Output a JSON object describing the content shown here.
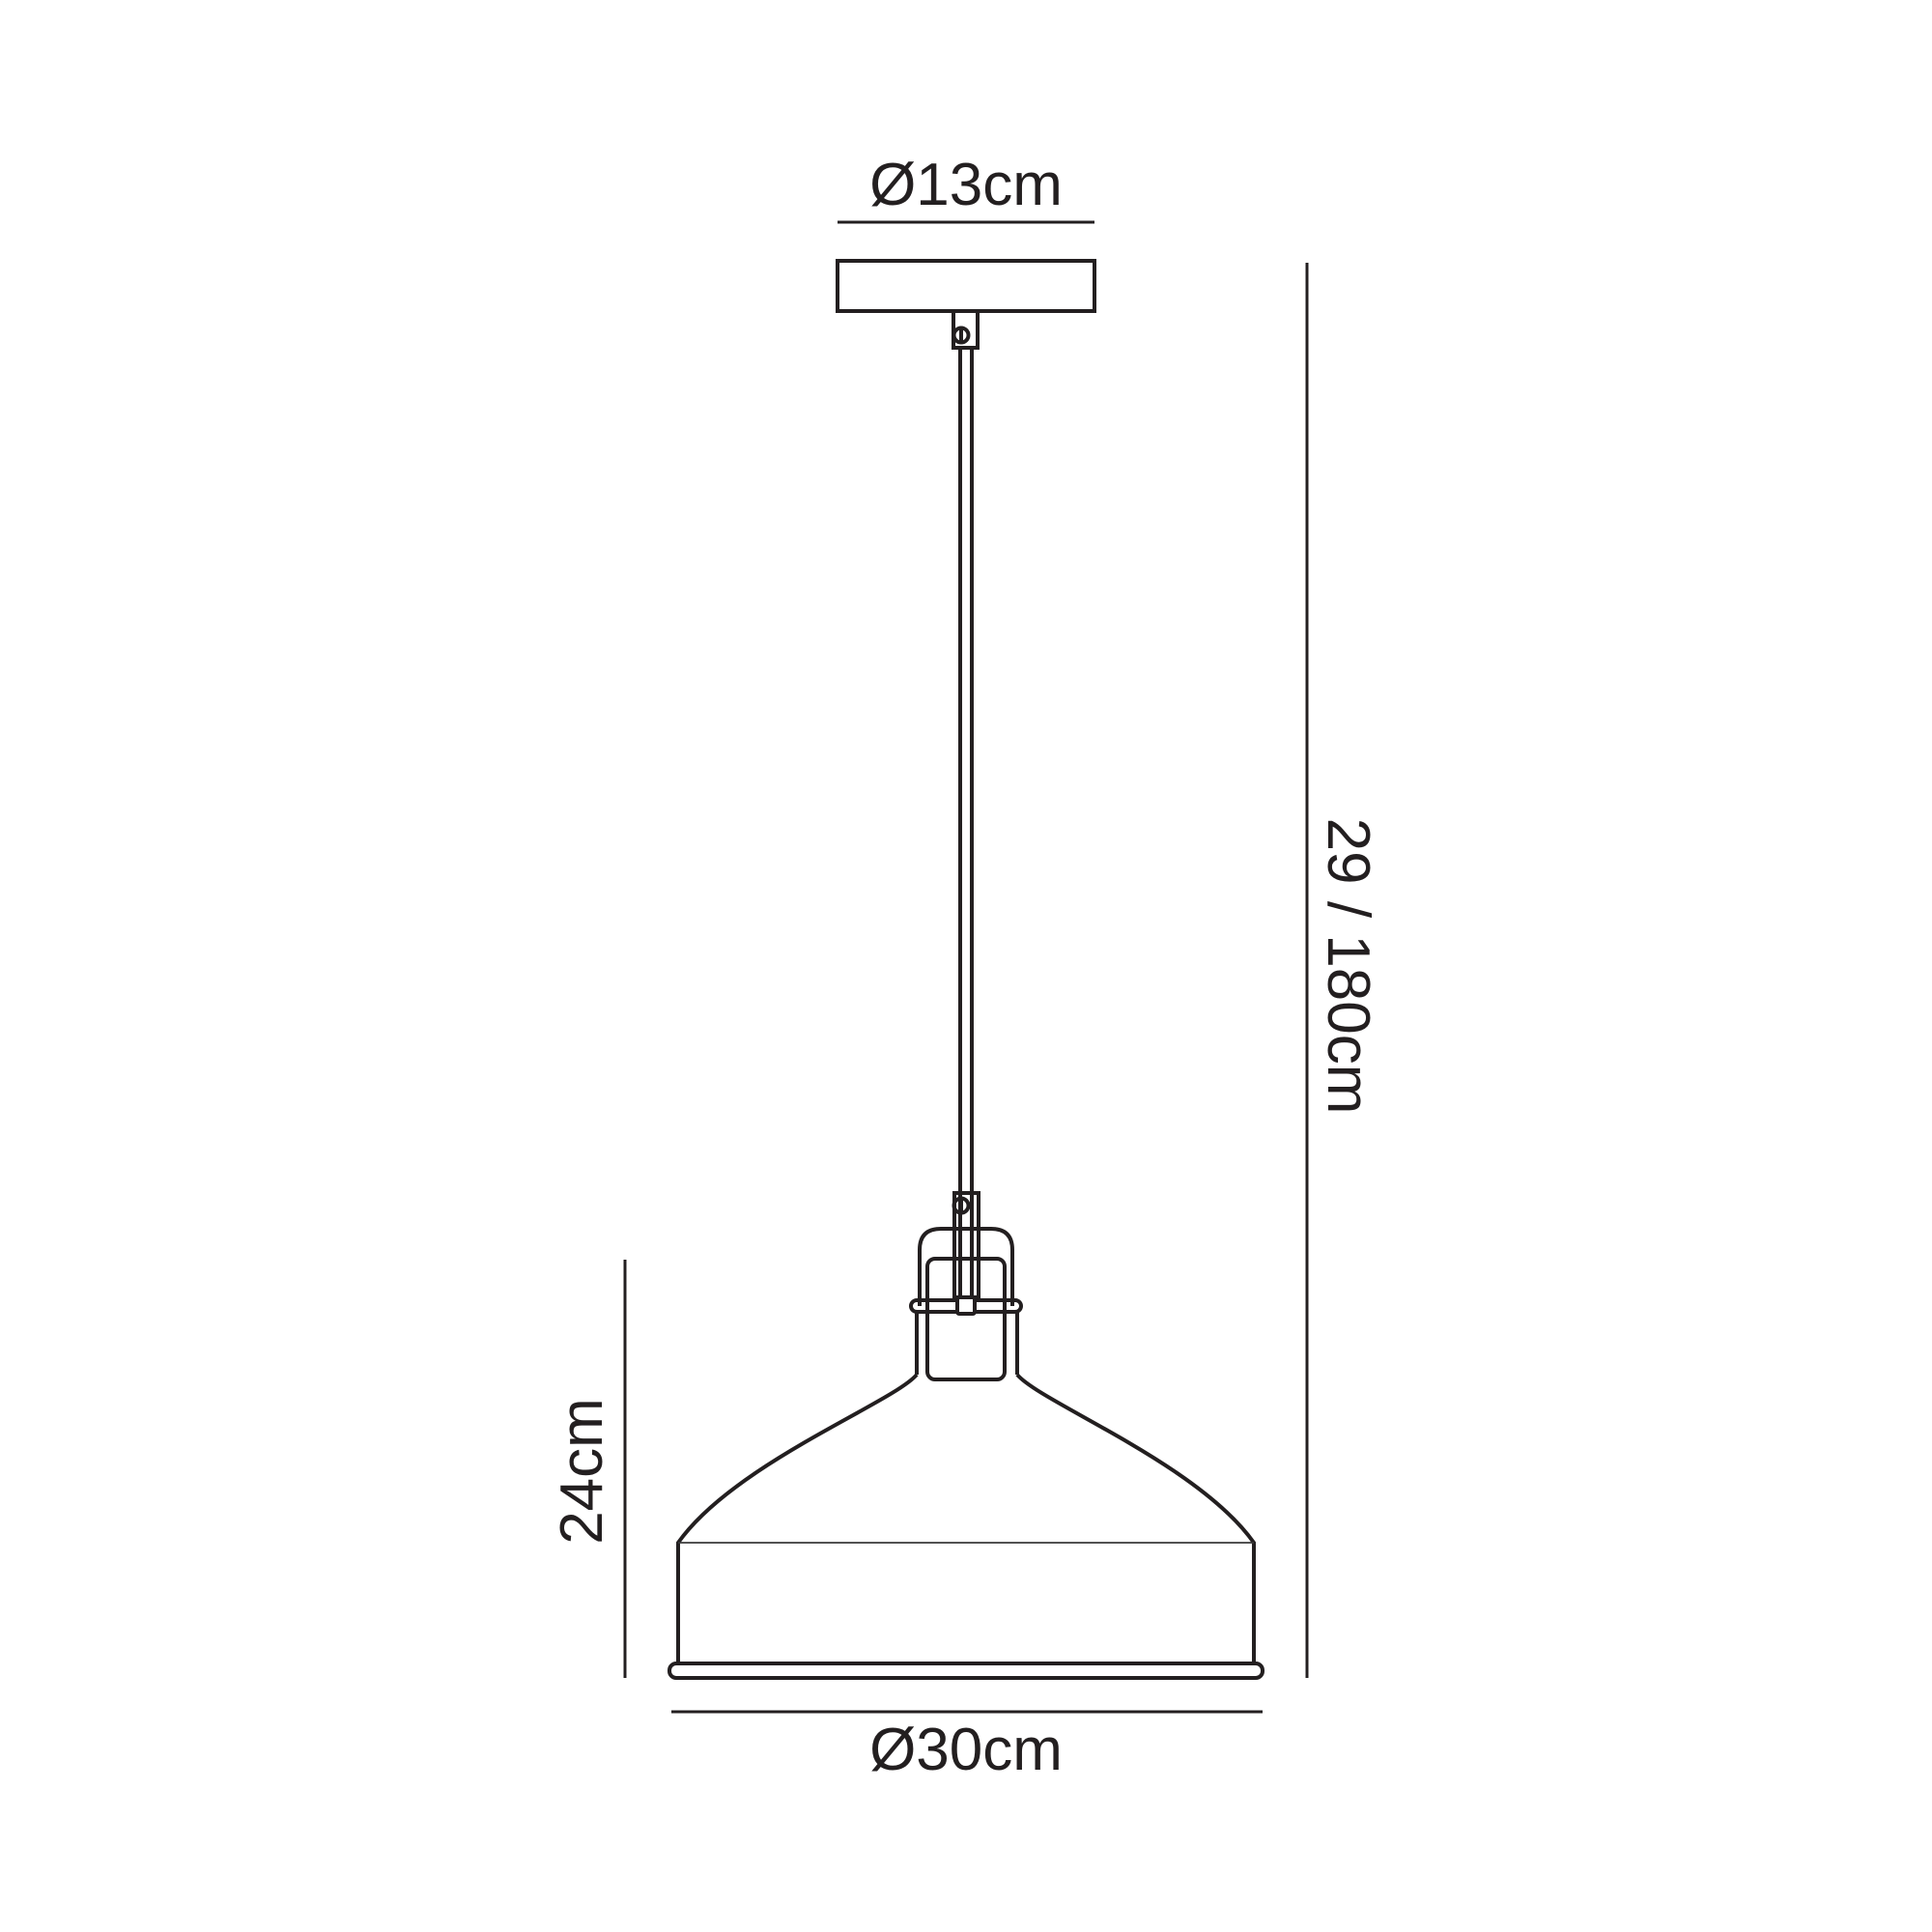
{
  "drawing": {
    "title": "pendant-lamp-dimension-diagram",
    "background_color": "#ffffff",
    "line_color": "#231f20",
    "labels": {
      "canopy_diameter": "Ø13cm",
      "drop_height": "29 / 180cm",
      "shade_height": "24cm",
      "shade_diameter": "Ø30cm"
    }
  }
}
